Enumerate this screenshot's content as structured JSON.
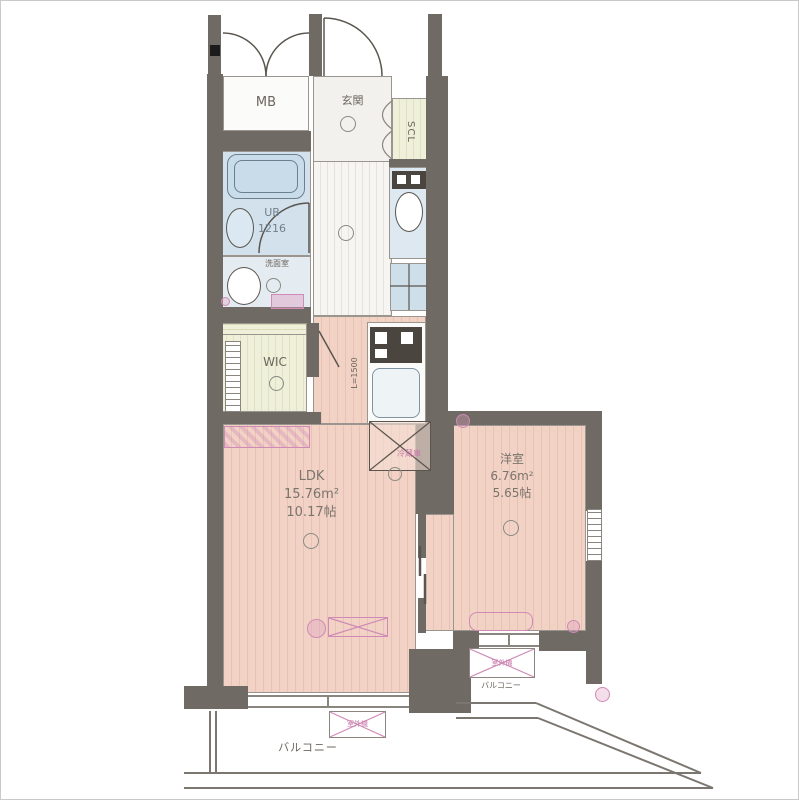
{
  "colors": {
    "wall": "#6f6a63",
    "ldk_floor": "#f2d2c5",
    "wic_floor": "#eff0da",
    "bath_floor": "#d2e1ec",
    "hall_floor": "#f6f5f1",
    "accent_pink": "#c879aa",
    "text": "#6b665f"
  },
  "rooms": {
    "mb": {
      "label": "MB"
    },
    "entrance": {
      "label": "玄関"
    },
    "shoe_closet": {
      "label": "SCL"
    },
    "bath": {
      "label": "UB",
      "size": "1216"
    },
    "washroom": {
      "label": "洗面室"
    },
    "walk_in_closet": {
      "label": "WIC"
    },
    "kitchen": {
      "counter_length": "L=1500"
    },
    "refrigerator": {
      "label": "冷蔵庫"
    },
    "ldk": {
      "label": "LDK",
      "area_m2": "15.76m²",
      "area_jo": "10.17帖"
    },
    "western_room": {
      "label": "洋室",
      "area_m2": "6.76m²",
      "area_jo": "5.65帖"
    },
    "balcony_left": {
      "label": "バルコニー"
    },
    "balcony_right": {
      "label": "バルコニー"
    },
    "outdoor_unit_left": {
      "label": "室外機"
    },
    "outdoor_unit_right": {
      "label": "室外機"
    }
  }
}
